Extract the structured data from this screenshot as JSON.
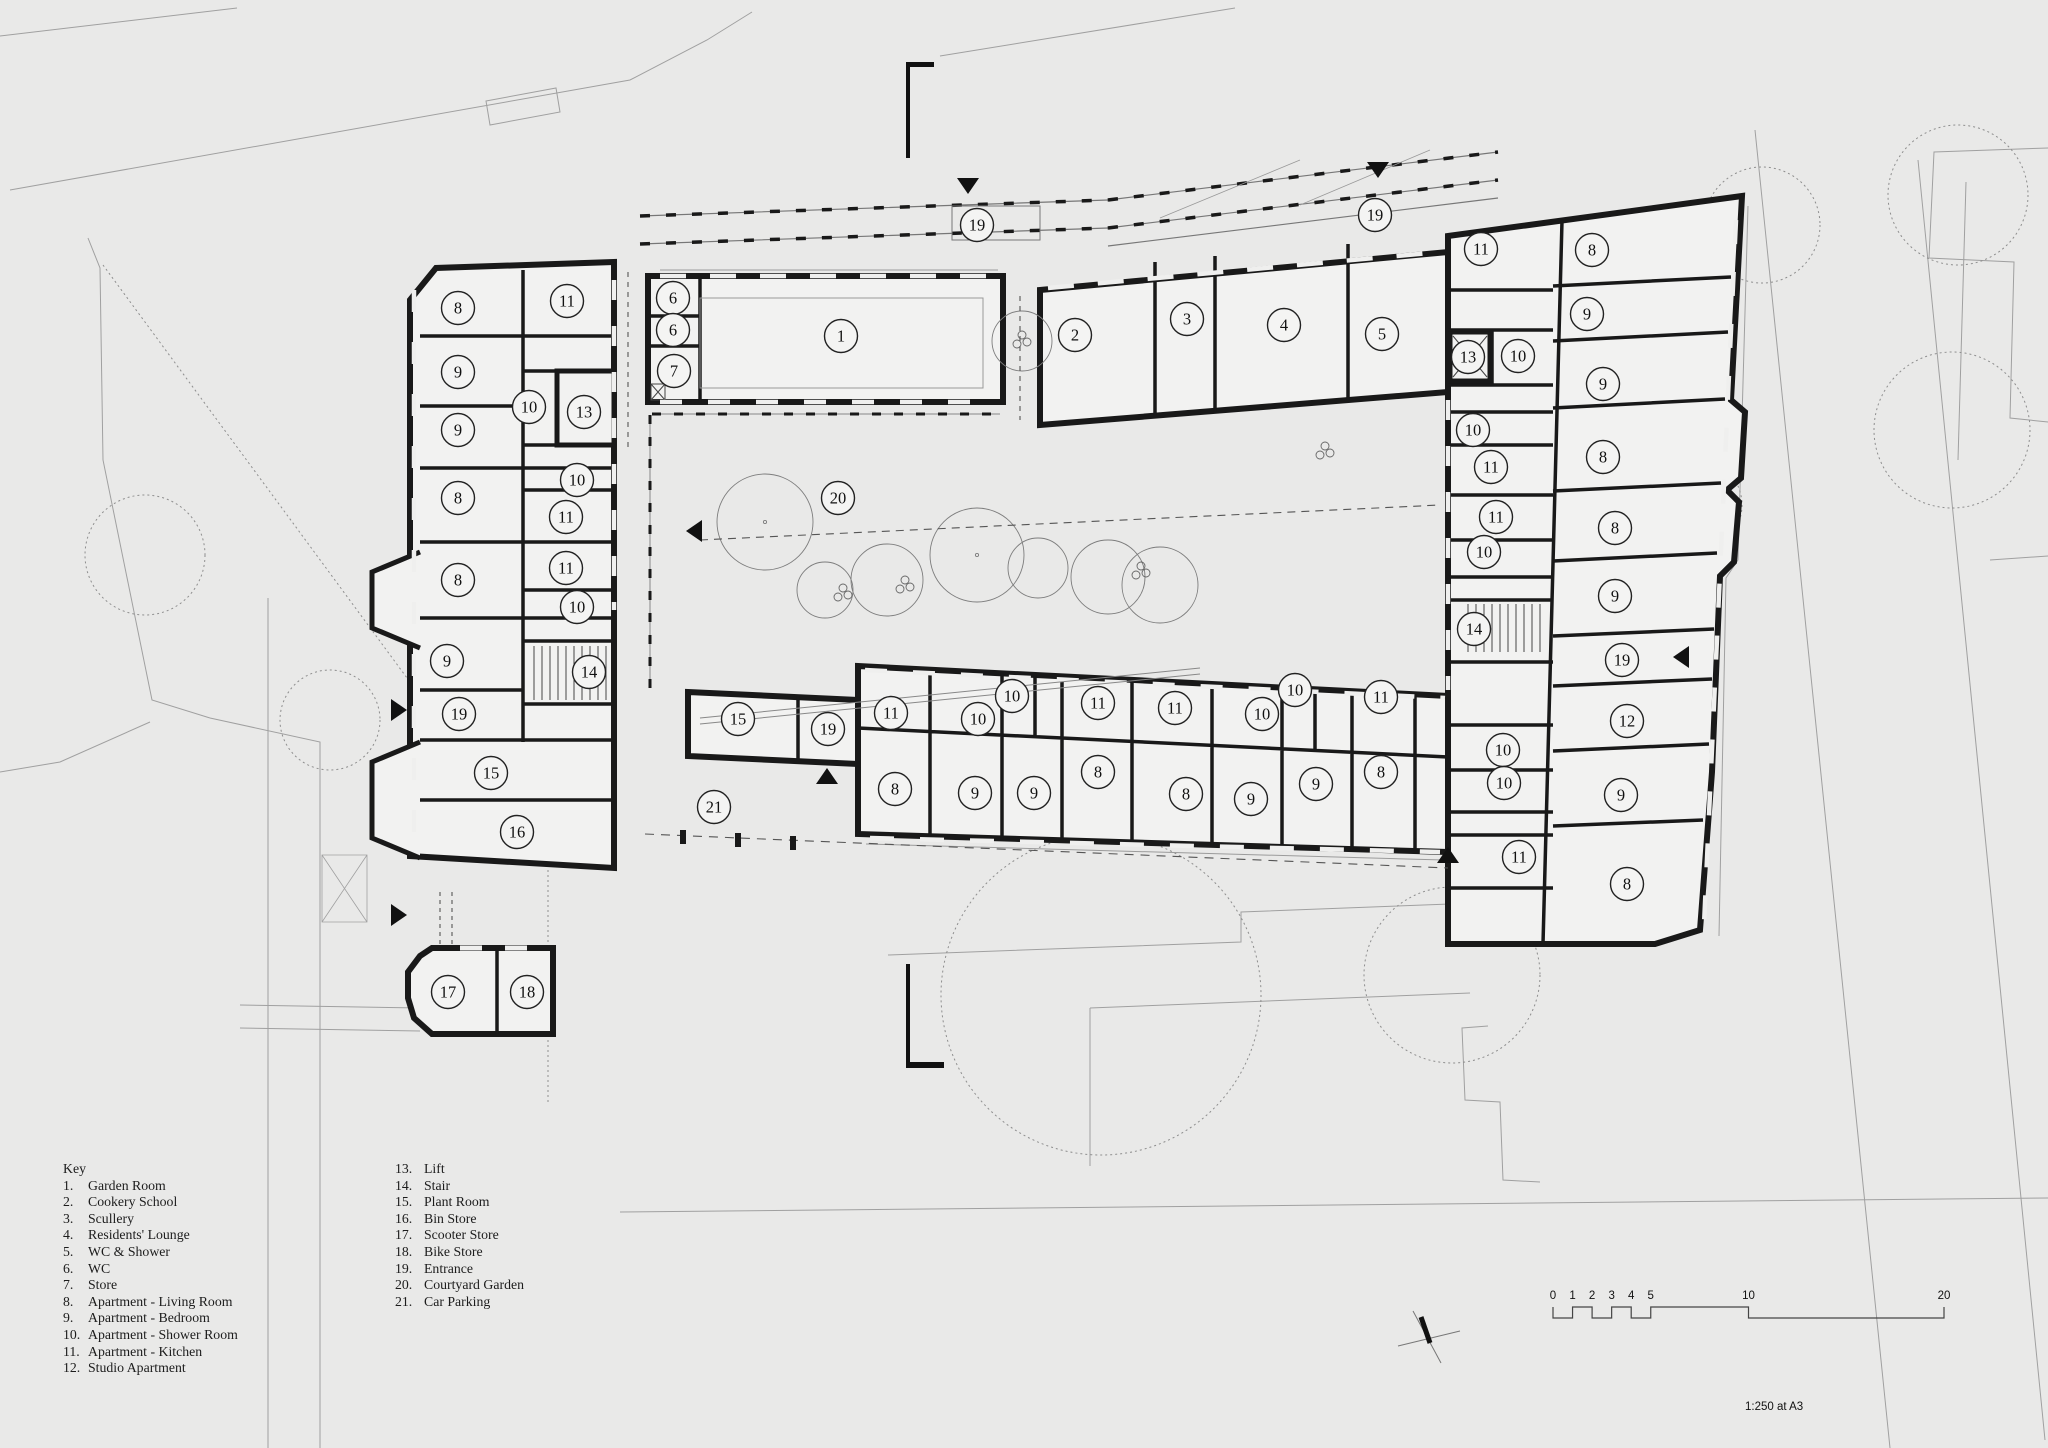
{
  "key": {
    "heading": "Key",
    "col1": [
      {
        "num": "1.",
        "label": "Garden Room"
      },
      {
        "num": "2.",
        "label": "Cookery School"
      },
      {
        "num": "3.",
        "label": "Scullery"
      },
      {
        "num": "4.",
        "label": "Residents' Lounge"
      },
      {
        "num": "5.",
        "label": "WC & Shower"
      },
      {
        "num": "6.",
        "label": "WC"
      },
      {
        "num": "7.",
        "label": "Store"
      },
      {
        "num": "8.",
        "label": "Apartment - Living Room"
      },
      {
        "num": "9.",
        "label": "Apartment  - Bedroom"
      },
      {
        "num": "10.",
        "label": "Apartment - Shower Room"
      },
      {
        "num": "11.",
        "label": "Apartment - Kitchen"
      },
      {
        "num": "12.",
        "label": "Studio Apartment"
      }
    ],
    "col2": [
      {
        "num": "13.",
        "label": "Lift"
      },
      {
        "num": "14.",
        "label": "Stair"
      },
      {
        "num": "15.",
        "label": "Plant Room"
      },
      {
        "num": "16.",
        "label": "Bin Store"
      },
      {
        "num": "17.",
        "label": "Scooter Store"
      },
      {
        "num": "18.",
        "label": "Bike Store"
      },
      {
        "num": "19.",
        "label": "Entrance"
      },
      {
        "num": "20.",
        "label": "Courtyard Garden"
      },
      {
        "num": "21.",
        "label": "Car Parking"
      }
    ]
  },
  "scale_bar": {
    "tick_labels": [
      "0",
      "1",
      "2",
      "3",
      "4",
      "5",
      "10",
      "20"
    ],
    "tick_values": [
      0,
      1,
      2,
      3,
      4,
      5,
      10,
      20
    ],
    "note": "1:250 at A3"
  },
  "plan": {
    "colors": {
      "background": "#e9e9e8",
      "wall": "#191919",
      "room_fill": "#f2f2f1",
      "context_line": "#a0a0a0"
    },
    "room_labels": [
      {
        "n": "8",
        "x": 458,
        "y": 308
      },
      {
        "n": "11",
        "x": 567,
        "y": 301
      },
      {
        "n": "9",
        "x": 458,
        "y": 372
      },
      {
        "n": "10",
        "x": 529,
        "y": 407
      },
      {
        "n": "13",
        "x": 584,
        "y": 412
      },
      {
        "n": "9",
        "x": 458,
        "y": 430
      },
      {
        "n": "8",
        "x": 458,
        "y": 498
      },
      {
        "n": "10",
        "x": 577,
        "y": 480
      },
      {
        "n": "11",
        "x": 566,
        "y": 517
      },
      {
        "n": "11",
        "x": 566,
        "y": 568
      },
      {
        "n": "8",
        "x": 458,
        "y": 580
      },
      {
        "n": "10",
        "x": 577,
        "y": 607
      },
      {
        "n": "9",
        "x": 447,
        "y": 661
      },
      {
        "n": "14",
        "x": 589,
        "y": 672
      },
      {
        "n": "19",
        "x": 459,
        "y": 714
      },
      {
        "n": "15",
        "x": 491,
        "y": 773
      },
      {
        "n": "16",
        "x": 517,
        "y": 832
      },
      {
        "n": "17",
        "x": 448,
        "y": 992
      },
      {
        "n": "18",
        "x": 527,
        "y": 992
      },
      {
        "n": "6",
        "x": 673,
        "y": 298
      },
      {
        "n": "6",
        "x": 673,
        "y": 330
      },
      {
        "n": "7",
        "x": 674,
        "y": 371
      },
      {
        "n": "1",
        "x": 841,
        "y": 336
      },
      {
        "n": "19",
        "x": 977,
        "y": 225
      },
      {
        "n": "2",
        "x": 1075,
        "y": 335
      },
      {
        "n": "3",
        "x": 1187,
        "y": 319
      },
      {
        "n": "4",
        "x": 1284,
        "y": 325
      },
      {
        "n": "5",
        "x": 1382,
        "y": 334
      },
      {
        "n": "19",
        "x": 1375,
        "y": 215
      },
      {
        "n": "11",
        "x": 1481,
        "y": 249
      },
      {
        "n": "8",
        "x": 1592,
        "y": 250
      },
      {
        "n": "9",
        "x": 1587,
        "y": 314
      },
      {
        "n": "13",
        "x": 1468,
        "y": 357
      },
      {
        "n": "10",
        "x": 1518,
        "y": 356
      },
      {
        "n": "9",
        "x": 1603,
        "y": 384
      },
      {
        "n": "10",
        "x": 1473,
        "y": 430
      },
      {
        "n": "11",
        "x": 1491,
        "y": 467
      },
      {
        "n": "8",
        "x": 1603,
        "y": 457
      },
      {
        "n": "11",
        "x": 1496,
        "y": 517
      },
      {
        "n": "8",
        "x": 1615,
        "y": 528
      },
      {
        "n": "10",
        "x": 1484,
        "y": 552
      },
      {
        "n": "9",
        "x": 1615,
        "y": 596
      },
      {
        "n": "14",
        "x": 1474,
        "y": 629
      },
      {
        "n": "19",
        "x": 1622,
        "y": 660
      },
      {
        "n": "12",
        "x": 1627,
        "y": 721
      },
      {
        "n": "10",
        "x": 1503,
        "y": 750
      },
      {
        "n": "10",
        "x": 1504,
        "y": 783
      },
      {
        "n": "9",
        "x": 1621,
        "y": 795
      },
      {
        "n": "11",
        "x": 1519,
        "y": 857
      },
      {
        "n": "8",
        "x": 1627,
        "y": 884
      },
      {
        "n": "15",
        "x": 738,
        "y": 719
      },
      {
        "n": "19",
        "x": 828,
        "y": 729
      },
      {
        "n": "21",
        "x": 714,
        "y": 807
      },
      {
        "n": "11",
        "x": 891,
        "y": 713
      },
      {
        "n": "8",
        "x": 895,
        "y": 789
      },
      {
        "n": "10",
        "x": 978,
        "y": 719
      },
      {
        "n": "10",
        "x": 1012,
        "y": 696
      },
      {
        "n": "9",
        "x": 975,
        "y": 793
      },
      {
        "n": "9",
        "x": 1034,
        "y": 793
      },
      {
        "n": "8",
        "x": 1098,
        "y": 772
      },
      {
        "n": "11",
        "x": 1098,
        "y": 703
      },
      {
        "n": "11",
        "x": 1175,
        "y": 708
      },
      {
        "n": "8",
        "x": 1186,
        "y": 794
      },
      {
        "n": "10",
        "x": 1262,
        "y": 714
      },
      {
        "n": "10",
        "x": 1295,
        "y": 690
      },
      {
        "n": "9",
        "x": 1251,
        "y": 799
      },
      {
        "n": "9",
        "x": 1316,
        "y": 784
      },
      {
        "n": "11",
        "x": 1381,
        "y": 697
      },
      {
        "n": "8",
        "x": 1381,
        "y": 772
      },
      {
        "n": "20",
        "x": 838,
        "y": 498
      }
    ],
    "entrance_markers": [
      {
        "dir": "down",
        "x": 968,
        "y": 186
      },
      {
        "dir": "down",
        "x": 1378,
        "y": 170
      },
      {
        "dir": "right",
        "x": 399,
        "y": 710
      },
      {
        "dir": "right",
        "x": 399,
        "y": 915
      },
      {
        "dir": "left",
        "x": 694,
        "y": 531
      },
      {
        "dir": "up",
        "x": 827,
        "y": 776
      },
      {
        "dir": "up",
        "x": 1448,
        "y": 855
      },
      {
        "dir": "left",
        "x": 1681,
        "y": 657
      }
    ]
  }
}
